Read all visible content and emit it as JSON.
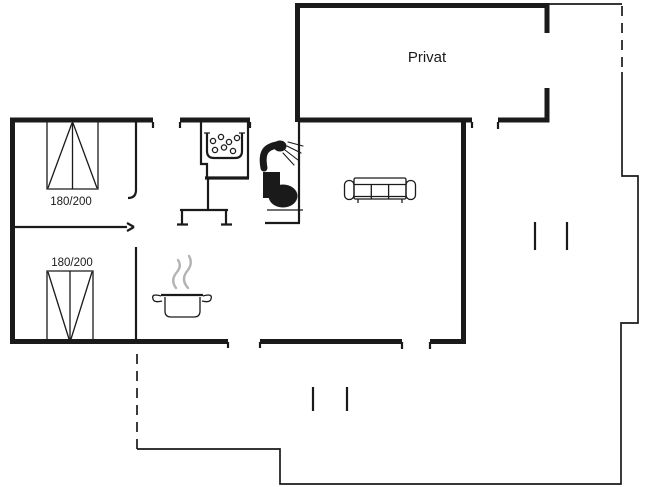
{
  "floorplan": {
    "private_room_label": "Privat",
    "beds": [
      {
        "size_label": "180/200"
      },
      {
        "size_label": "180/200"
      }
    ],
    "icons": [
      "double-bed-icon",
      "double-bed-icon",
      "washbasin-bubbles-icon",
      "shower-icon",
      "toilet-icon",
      "cooking-pot-steam-icon",
      "sofa-icon"
    ],
    "colors": {
      "wall": "#1a1a1a",
      "steam": "#b3b3b3",
      "background": "#ffffff"
    }
  }
}
